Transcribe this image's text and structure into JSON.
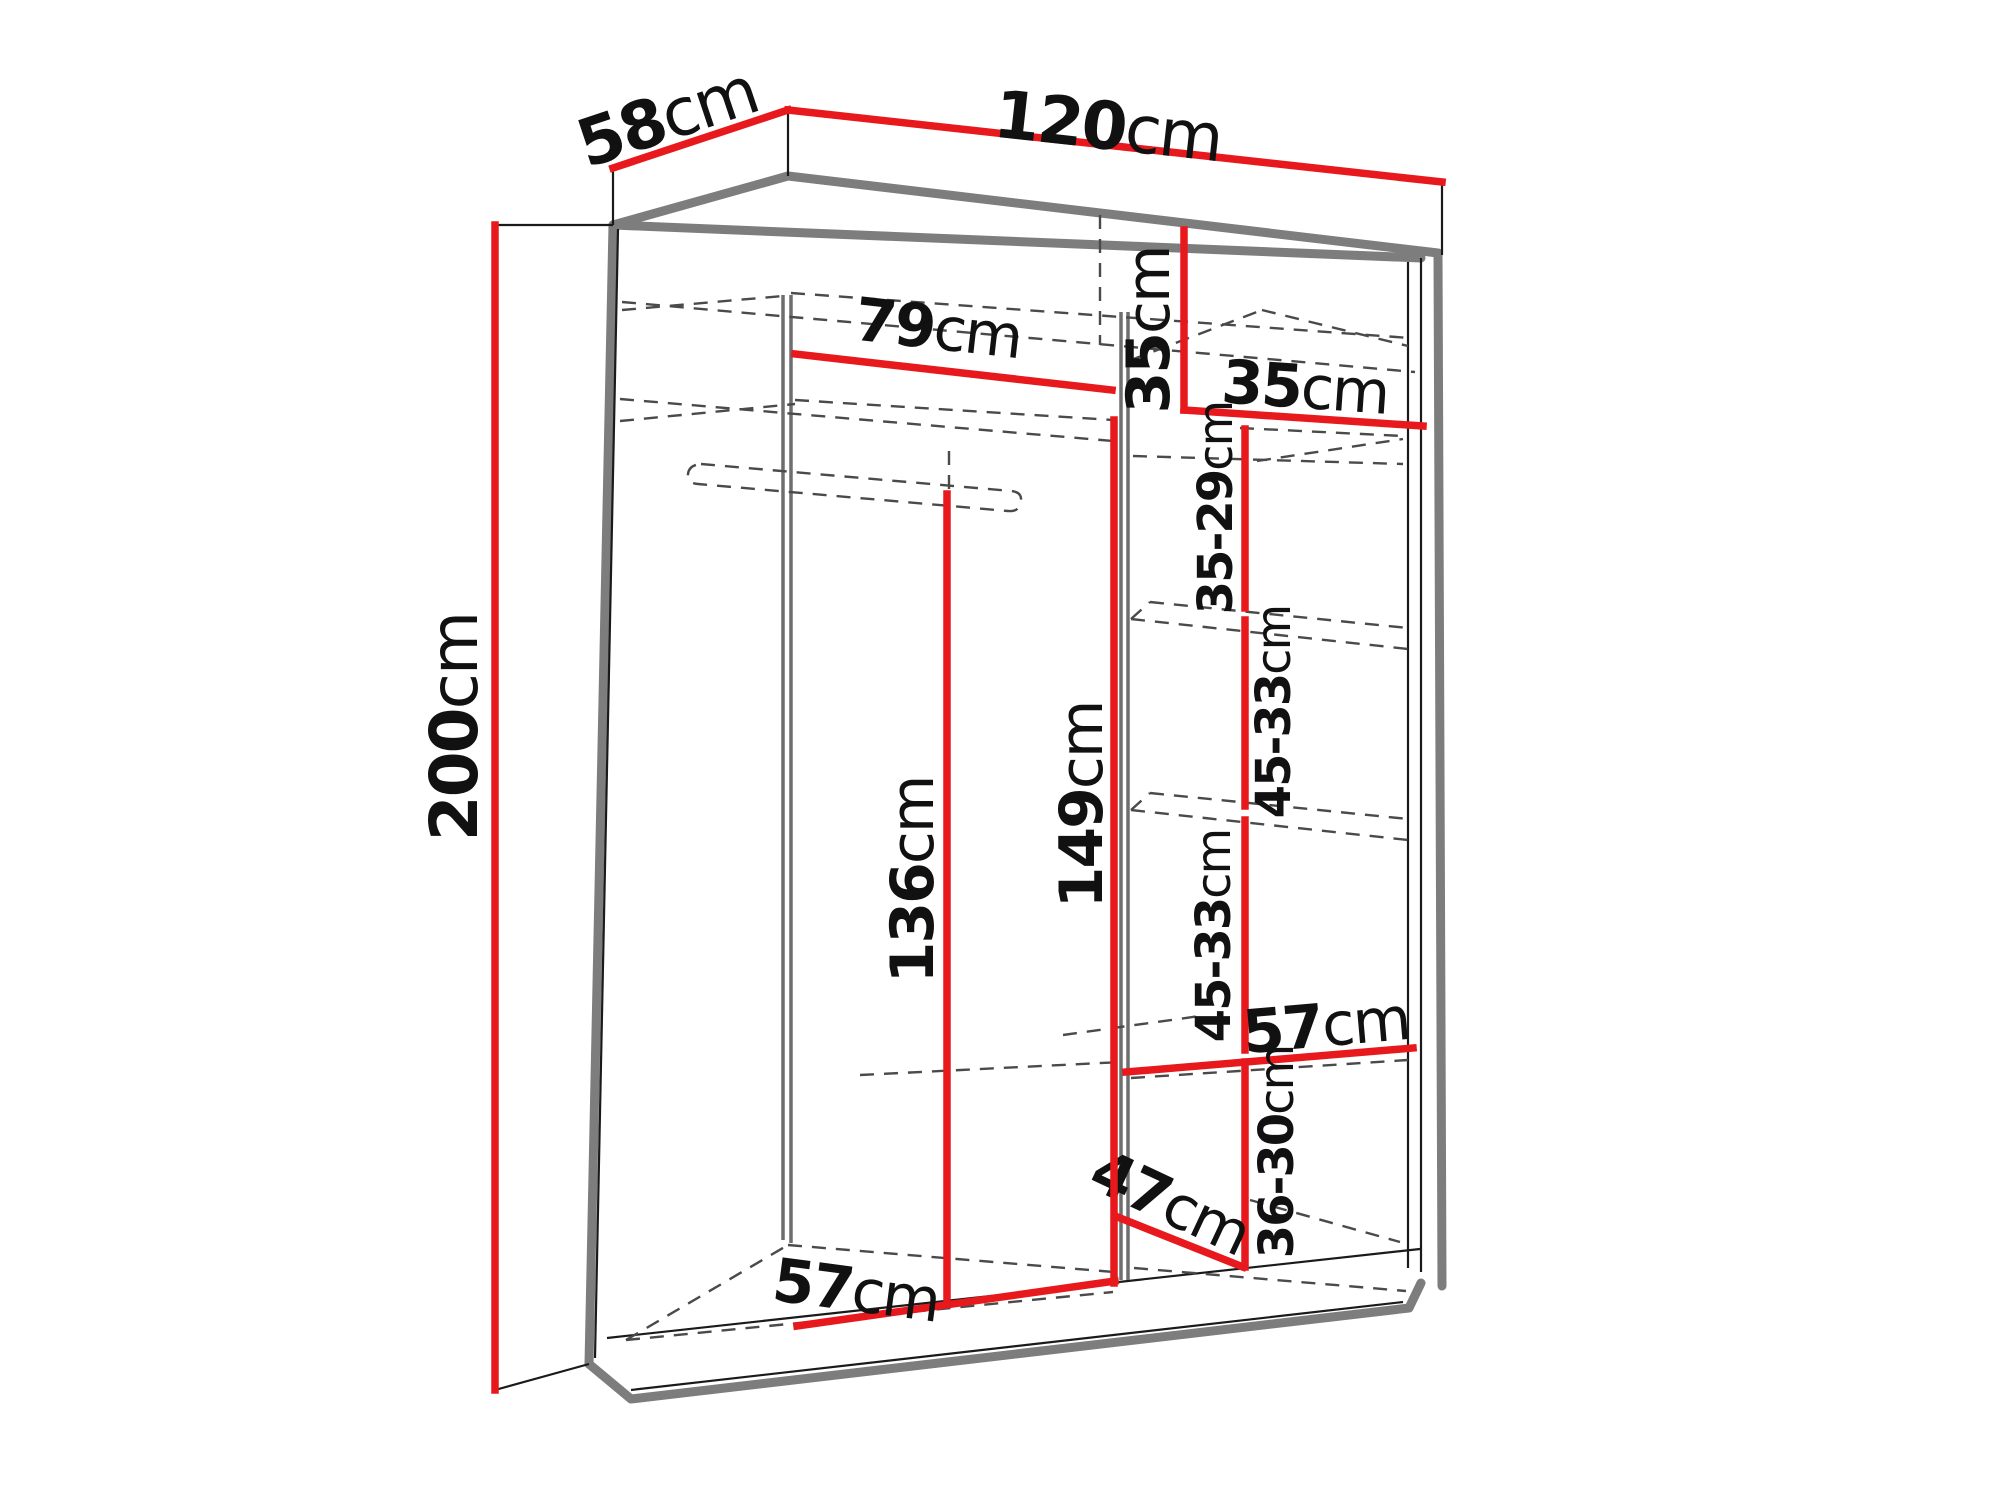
{
  "diagram": {
    "kind": "wardrobe-dimension-diagram",
    "unit": "cm",
    "overall": {
      "width": "120",
      "depth": "58",
      "height": "200"
    },
    "colors": {
      "dimension_line": "#e8191c",
      "outline_gray": "#7d7d7d",
      "text": "#111111",
      "background": "#ffffff"
    },
    "dimensions": [
      {
        "id": "depth-top",
        "num": "58",
        "unit": "cm",
        "size": "lg",
        "line": [
          [
            613,
            168
          ],
          [
            788,
            110
          ]
        ],
        "lx": 667,
        "ly": 117,
        "rot": -18.5
      },
      {
        "id": "width-top",
        "num": "120",
        "unit": "cm",
        "size": "lg",
        "line": [
          [
            788,
            110
          ],
          [
            1442,
            182
          ]
        ],
        "lx": 1108,
        "ly": 126,
        "rot": 6.3
      },
      {
        "id": "height-left",
        "num": "200",
        "unit": "cm",
        "size": "lg",
        "line": [
          [
            495,
            225
          ],
          [
            495,
            1390
          ]
        ],
        "lx": 454,
        "ly": 727,
        "rot": -90
      },
      {
        "id": "hanging-width",
        "num": "79",
        "unit": "cm",
        "size": "md",
        "line": [
          [
            795,
            354
          ],
          [
            1112,
            390
          ]
        ],
        "lx": 938,
        "ly": 329,
        "rot": 6.5
      },
      {
        "id": "top-section-height",
        "num": "35",
        "unit": "cm",
        "size": "md",
        "line": [
          [
            1184,
            230
          ],
          [
            1184,
            410
          ]
        ],
        "lx": 1149,
        "ly": 330,
        "rot": -90
      },
      {
        "id": "top-shelf-width",
        "num": "35",
        "unit": "cm",
        "size": "md",
        "line": [
          [
            1184,
            410
          ],
          [
            1423,
            426
          ]
        ],
        "lx": 1305,
        "ly": 388,
        "rot": 4
      },
      {
        "id": "shelf-gap-1",
        "num": "35-29",
        "unit": "cm",
        "size": "sm",
        "line": [
          [
            1245,
            429
          ],
          [
            1245,
            608
          ]
        ],
        "lx": 1216,
        "ly": 508,
        "rot": -90
      },
      {
        "id": "shelf-gap-2",
        "num": "45-33",
        "unit": "cm",
        "size": "sm",
        "line": [
          [
            1245,
            620
          ],
          [
            1245,
            806
          ]
        ],
        "lx": 1274,
        "ly": 712,
        "rot": -90
      },
      {
        "id": "shelf-gap-3",
        "num": "45-33",
        "unit": "cm",
        "size": "sm",
        "line": [
          [
            1245,
            820
          ],
          [
            1245,
            1050
          ]
        ],
        "lx": 1214,
        "ly": 936,
        "rot": -90
      },
      {
        "id": "right-shelf-width",
        "num": "57",
        "unit": "cm",
        "size": "md",
        "line": [
          [
            1126,
            1072
          ],
          [
            1413,
            1048
          ]
        ],
        "lx": 1326,
        "ly": 1026,
        "rot": -5
      },
      {
        "id": "shelf-gap-4",
        "num": "36-30",
        "unit": "cm",
        "size": "sm",
        "line": [
          [
            1245,
            1062
          ],
          [
            1245,
            1267
          ]
        ],
        "lx": 1277,
        "ly": 1152,
        "rot": -90
      },
      {
        "id": "bottom-depth",
        "num": "47",
        "unit": "cm",
        "size": "md",
        "line": [
          [
            1115,
            1216
          ],
          [
            1243,
            1267
          ]
        ],
        "lx": 1170,
        "ly": 1203,
        "rot": 25
      },
      {
        "id": "hanging-height",
        "num": "136",
        "unit": "cm",
        "size": "md",
        "line": [
          [
            947,
            494
          ],
          [
            947,
            1303
          ]
        ],
        "lx": 913,
        "ly": 880,
        "rot": -90
      },
      {
        "id": "open-height",
        "num": "149",
        "unit": "cm",
        "size": "md",
        "line": [
          [
            1114,
            420
          ],
          [
            1114,
            1283
          ]
        ],
        "lx": 1082,
        "ly": 805,
        "rot": -90
      },
      {
        "id": "left-floor-width",
        "num": "57",
        "unit": "cm",
        "size": "md",
        "line": [
          [
            797,
            1326
          ],
          [
            1115,
            1281
          ]
        ],
        "lx": 856,
        "ly": 1291,
        "rot": 7.5
      }
    ],
    "connectors": [
      [
        [
          495,
          225
        ],
        [
          613,
          225
        ]
      ],
      [
        [
          495,
          1390
        ],
        [
          589,
          1364
        ]
      ],
      [
        [
          613,
          168
        ],
        [
          613,
          225
        ]
      ],
      [
        [
          788,
          110
        ],
        [
          788,
          176
        ]
      ],
      [
        [
          1442,
          182
        ],
        [
          1442,
          255
        ]
      ]
    ]
  }
}
